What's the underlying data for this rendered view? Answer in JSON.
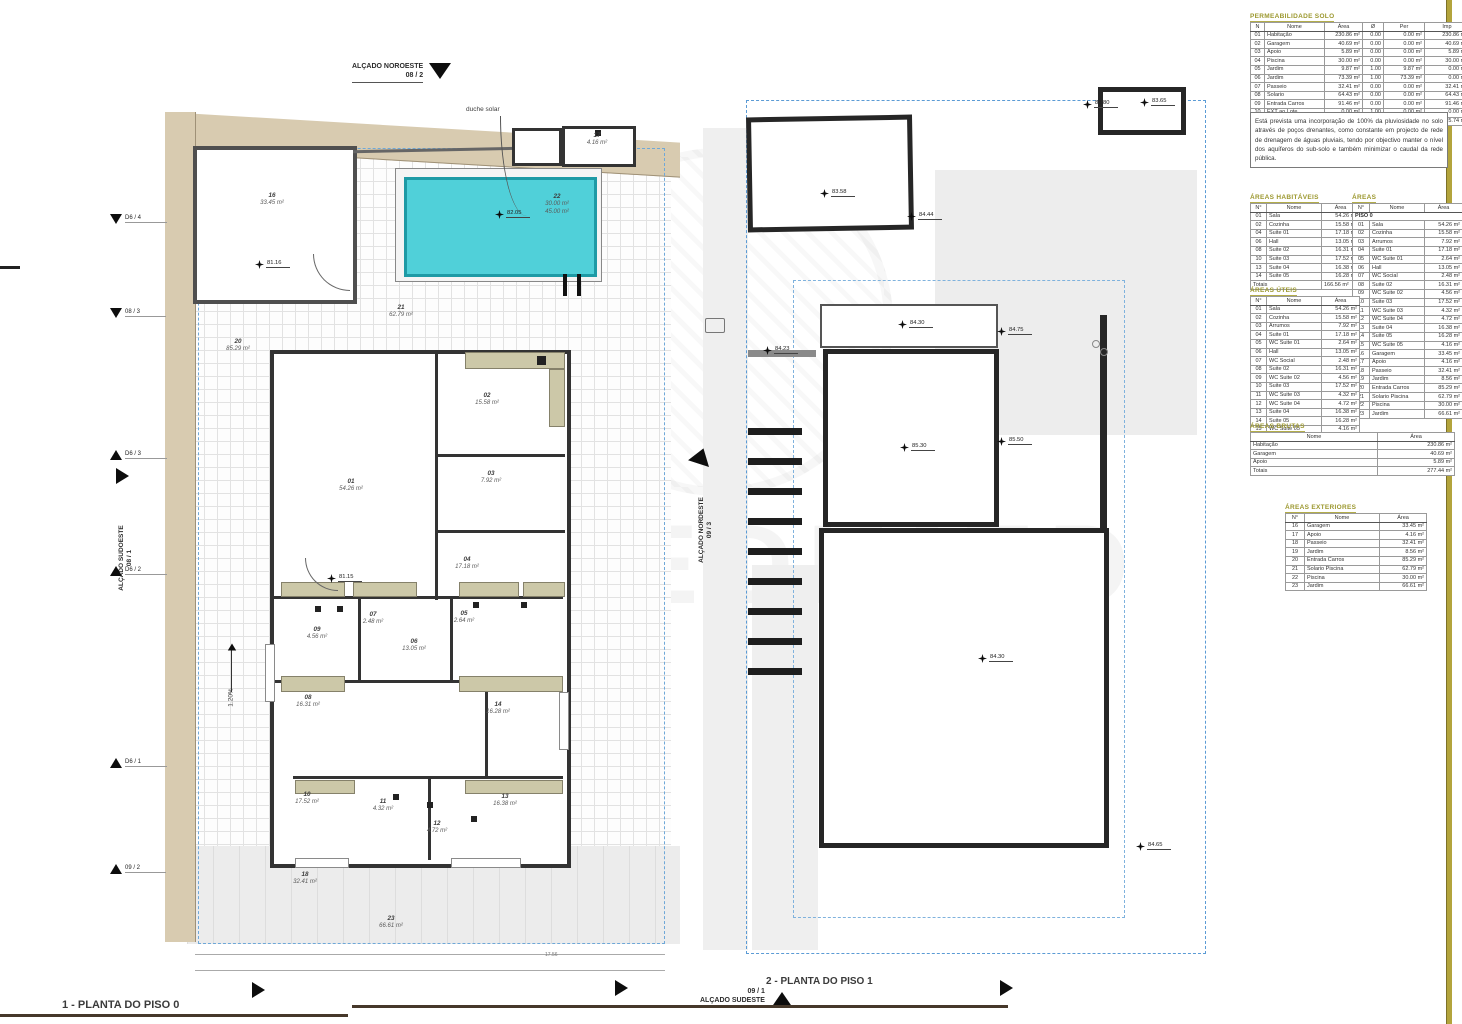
{
  "titles": {
    "plan0": "1 - PLANTA DO PISO 0",
    "plan1": "2 - PLANTA DO PISO 1"
  },
  "watermark": "PREDIMED",
  "elevations": {
    "top": {
      "name": "ALÇADO NOROESTE",
      "ref": "08 / 2"
    },
    "left": {
      "name": "ALÇADO SUDOESTE",
      "ref": "08 / 1"
    },
    "right": {
      "name": "ALÇADO NORDESTE",
      "ref": "09 / 3"
    },
    "bottom": {
      "name": "ALÇADO SUDESTE",
      "ref": "09 / 1"
    }
  },
  "section_markers": [
    {
      "label": "D6 / 4",
      "dir": "down",
      "x": 110,
      "y": 214
    },
    {
      "label": "08 / 3",
      "dir": "down",
      "x": 110,
      "y": 308
    },
    {
      "label": "D6 / 3",
      "dir": "up",
      "x": 110,
      "y": 450
    },
    {
      "label": "D6 / 2",
      "dir": "up",
      "x": 110,
      "y": 566
    },
    {
      "label": "D6 / 1",
      "dir": "up",
      "x": 110,
      "y": 758
    },
    {
      "label": "09 / 2",
      "dir": "up",
      "x": 110,
      "y": 864
    }
  ],
  "annotations": {
    "duche": "duche solar",
    "slope": "1.20%",
    "dim": "17.56"
  },
  "plan0": {
    "rooms": [
      {
        "num": "16",
        "lines": [
          "33.45 m²"
        ],
        "x": 107,
        "y": 112
      },
      {
        "num": "17",
        "lines": [
          "4.16 m²"
        ],
        "x": 432,
        "y": 52
      },
      {
        "num": "22",
        "lines": [
          "30.00 m²",
          "45.00 m²"
        ],
        "x": 392,
        "y": 117
      },
      {
        "num": "21",
        "lines": [
          "62.79 m²"
        ],
        "x": 236,
        "y": 224
      },
      {
        "num": "20",
        "lines": [
          "85.29 m²"
        ],
        "x": 73,
        "y": 258
      },
      {
        "num": "01",
        "lines": [
          "54.26 m²"
        ],
        "x": 186,
        "y": 398
      },
      {
        "num": "02",
        "lines": [
          "15.58 m²"
        ],
        "x": 322,
        "y": 312
      },
      {
        "num": "03",
        "lines": [
          "7.92 m²"
        ],
        "x": 326,
        "y": 390
      },
      {
        "num": "04",
        "lines": [
          "17.18 m²"
        ],
        "x": 302,
        "y": 476
      },
      {
        "num": "05",
        "lines": [
          "2.64 m²"
        ],
        "x": 299,
        "y": 530
      },
      {
        "num": "07",
        "lines": [
          "2.48 m²"
        ],
        "x": 208,
        "y": 531
      },
      {
        "num": "09",
        "lines": [
          "4.56 m²"
        ],
        "x": 152,
        "y": 546
      },
      {
        "num": "06",
        "lines": [
          "13.05 m²"
        ],
        "x": 249,
        "y": 558
      },
      {
        "num": "08",
        "lines": [
          "16.31 m²"
        ],
        "x": 143,
        "y": 614
      },
      {
        "num": "14",
        "lines": [
          "16.28 m²"
        ],
        "x": 333,
        "y": 621
      },
      {
        "num": "10",
        "lines": [
          "17.52 m²"
        ],
        "x": 142,
        "y": 711
      },
      {
        "num": "11",
        "lines": [
          "4.32 m²"
        ],
        "x": 218,
        "y": 718
      },
      {
        "num": "12",
        "lines": [
          "4.72 m²"
        ],
        "x": 272,
        "y": 740
      },
      {
        "num": "13",
        "lines": [
          "16.38 m²"
        ],
        "x": 340,
        "y": 713
      },
      {
        "num": "18",
        "lines": [
          "32.41 m²"
        ],
        "x": 140,
        "y": 791
      },
      {
        "num": "23",
        "lines": [
          "66.61 m²"
        ],
        "x": 226,
        "y": 835
      }
    ],
    "spots": [
      {
        "label": "81.16",
        "x": 90,
        "y": 172
      },
      {
        "label": "81.15",
        "x": 162,
        "y": 486
      },
      {
        "label": "82.05",
        "x": 330,
        "y": 122
      }
    ]
  },
  "plan1": {
    "spots": [
      {
        "label": "83.80",
        "x": 1083,
        "y": 100
      },
      {
        "label": "83.65",
        "x": 1140,
        "y": 98
      },
      {
        "label": "83.58",
        "x": 820,
        "y": 189
      },
      {
        "label": "84.44",
        "x": 907,
        "y": 212
      },
      {
        "label": "84.30",
        "x": 898,
        "y": 320
      },
      {
        "label": "84.75",
        "x": 997,
        "y": 327
      },
      {
        "label": "84.23",
        "x": 763,
        "y": 346
      },
      {
        "label": "85.30",
        "x": 900,
        "y": 443
      },
      {
        "label": "85.50",
        "x": 997,
        "y": 437
      },
      {
        "label": "84.30",
        "x": 978,
        "y": 654
      },
      {
        "label": "84.65",
        "x": 1136,
        "y": 842
      }
    ]
  },
  "tables": {
    "note": "Está prevista uma incorporação de 100% da pluviosidade no solo através de poços drenantes, como constante em projecto de rede de drenagem de águas pluviais, tendo por objectivo manter o nível dos aquíferos do sub-solo e também minimizar o caudal da rede pública.",
    "permeabilidade": {
      "title": "PERMEABILIDADE SOLO",
      "columns": [
        "N",
        "Nome",
        "Área",
        "Ø",
        "Per",
        "Imp"
      ],
      "rows": [
        [
          "01",
          "Habitação",
          "230.86 m²",
          "0.00",
          "0.00 m²",
          "230.86 m²"
        ],
        [
          "02",
          "Garagem",
          "40.69 m²",
          "0.00",
          "0.00 m²",
          "40.69 m²"
        ],
        [
          "03",
          "Apoio",
          "5.89 m²",
          "0.00",
          "0.00 m²",
          "5.89 m²"
        ],
        [
          "04",
          "Piscina",
          "30.00 m²",
          "0.00",
          "0.00 m²",
          "30.00 m²"
        ],
        [
          "05",
          "Jardim",
          "9.87 m²",
          "1.00",
          "9.87 m²",
          "0.00 m²"
        ],
        [
          "06",
          "Jardim",
          "73.39 m²",
          "1.00",
          "73.39 m²",
          "0.00 m²"
        ],
        [
          "07",
          "Passeio",
          "32.41 m²",
          "0.00",
          "0.00 m²",
          "32.41 m²"
        ],
        [
          "08",
          "Solario",
          "64.43 m²",
          "0.00",
          "0.00 m²",
          "64.43 m²"
        ],
        [
          "09",
          "Entrada Carros",
          "91.46 m²",
          "0.00",
          "0.00 m²",
          "91.46 m²"
        ],
        [
          "10",
          "EXT ao Lote",
          "0.00 m²",
          "1.00",
          "0.00 m²",
          "0.00 m²"
        ]
      ],
      "totalSpan": 2,
      "total": [
        "Total",
        "579.00 m²",
        "",
        "83.27 m²",
        "495.74 m²"
      ]
    },
    "habitaveis": {
      "title": "ÁREAS HABITÁVEIS",
      "columns": [
        "N°",
        "Nome",
        "Área"
      ],
      "rows": [
        [
          "01",
          "Sala",
          "54.26 m²"
        ],
        [
          "02",
          "Cozinha",
          "15.58 m²"
        ],
        [
          "04",
          "Suite 01",
          "17.18 m²"
        ],
        [
          "06",
          "Hall",
          "13.05 m²"
        ],
        [
          "08",
          "Suite 02",
          "16.31 m²"
        ],
        [
          "10",
          "Suite 03",
          "17.52 m²"
        ],
        [
          "13",
          "Suite 04",
          "16.38 m²"
        ],
        [
          "14",
          "Suite 05",
          "16.28 m²"
        ]
      ],
      "totalSpan": 2,
      "total": [
        "Totais",
        "166.56 m²"
      ]
    },
    "areas": {
      "title": "ÁREAS",
      "columns": [
        "N°",
        "Nome",
        "Área"
      ],
      "group": "PISO 0",
      "rows": [
        [
          "01",
          "Sala",
          "54.26 m²"
        ],
        [
          "02",
          "Cozinha",
          "15.58 m²"
        ],
        [
          "03",
          "Arrumos",
          "7.92 m²"
        ],
        [
          "04",
          "Suite 01",
          "17.18 m²"
        ],
        [
          "05",
          "WC Suite 01",
          "2.64 m²"
        ],
        [
          "06",
          "Hall",
          "13.05 m²"
        ],
        [
          "07",
          "WC Social",
          "2.48 m²"
        ],
        [
          "08",
          "Suite 02",
          "16.31 m²"
        ],
        [
          "09",
          "WC Suite 02",
          "4.56 m²"
        ],
        [
          "10",
          "Suite 03",
          "17.52 m²"
        ],
        [
          "11",
          "WC Suite 03",
          "4.32 m²"
        ],
        [
          "12",
          "WC Suite 04",
          "4.72 m²"
        ],
        [
          "13",
          "Suite 04",
          "16.38 m²"
        ],
        [
          "14",
          "Suite 05",
          "16.28 m²"
        ],
        [
          "15",
          "WC Suite 05",
          "4.16 m²"
        ],
        [
          "16",
          "Garagem",
          "33.45 m²"
        ],
        [
          "17",
          "Apoio",
          "4.16 m²"
        ],
        [
          "18",
          "Passeio",
          "32.41 m²"
        ],
        [
          "19",
          "Jardim",
          "8.56 m²"
        ],
        [
          "20",
          "Entrada Carros",
          "85.29 m²"
        ],
        [
          "21",
          "Solario Piscina",
          "62.79 m²"
        ],
        [
          "22",
          "Piscina",
          "30.00 m²"
        ],
        [
          "23",
          "Jardim",
          "66.61 m²"
        ]
      ]
    },
    "uteis": {
      "title": "ÁREAS ÚTEIS",
      "columns": [
        "N°",
        "Nome",
        "Área"
      ],
      "rows": [
        [
          "01",
          "Sala",
          "54.26 m²"
        ],
        [
          "02",
          "Cozinha",
          "15.58 m²"
        ],
        [
          "03",
          "Arrumos",
          "7.92 m²"
        ],
        [
          "04",
          "Suite 01",
          "17.18 m²"
        ],
        [
          "05",
          "WC Suite 01",
          "2.64 m²"
        ],
        [
          "06",
          "Hall",
          "13.05 m²"
        ],
        [
          "07",
          "WC Social",
          "2.48 m²"
        ],
        [
          "08",
          "Suite 02",
          "16.31 m²"
        ],
        [
          "09",
          "WC Suite 02",
          "4.56 m²"
        ],
        [
          "10",
          "Suite 03",
          "17.52 m²"
        ],
        [
          "11",
          "WC Suite 03",
          "4.32 m²"
        ],
        [
          "12",
          "WC Suite 04",
          "4.72 m²"
        ],
        [
          "13",
          "Suite 04",
          "16.38 m²"
        ],
        [
          "14",
          "Suite 05",
          "16.28 m²"
        ],
        [
          "15",
          "WC Suite 05",
          "4.16 m²"
        ]
      ],
      "totalSpan": 2,
      "total": [
        "Total",
        "199.31 m²"
      ]
    },
    "brutas": {
      "title": "ÁREAS BRUTAS",
      "columns": [
        "Nome",
        "Área"
      ],
      "rows": [
        [
          "Habitação",
          "230.86 m²"
        ],
        [
          "Garagem",
          "40.69 m²"
        ],
        [
          "Apoio",
          "5.89 m²"
        ]
      ],
      "totalSpan": 1,
      "total": [
        "Totais",
        "277.44 m²"
      ]
    },
    "exteriores": {
      "title": "ÁREAS EXTERIORES",
      "columns": [
        "N°",
        "Nome",
        "Área"
      ],
      "rows": [
        [
          "16",
          "Garagem",
          "33.45 m²"
        ],
        [
          "17",
          "Apoio",
          "4.16 m²"
        ],
        [
          "18",
          "Passeio",
          "32.41 m²"
        ],
        [
          "19",
          "Jardim",
          "8.56 m²"
        ],
        [
          "20",
          "Entrada Carros",
          "85.29 m²"
        ],
        [
          "21",
          "Solario Piscina",
          "62.79 m²"
        ],
        [
          "22",
          "Piscina",
          "30.00 m²"
        ],
        [
          "23",
          "Jardim",
          "66.61 m²"
        ]
      ]
    }
  }
}
